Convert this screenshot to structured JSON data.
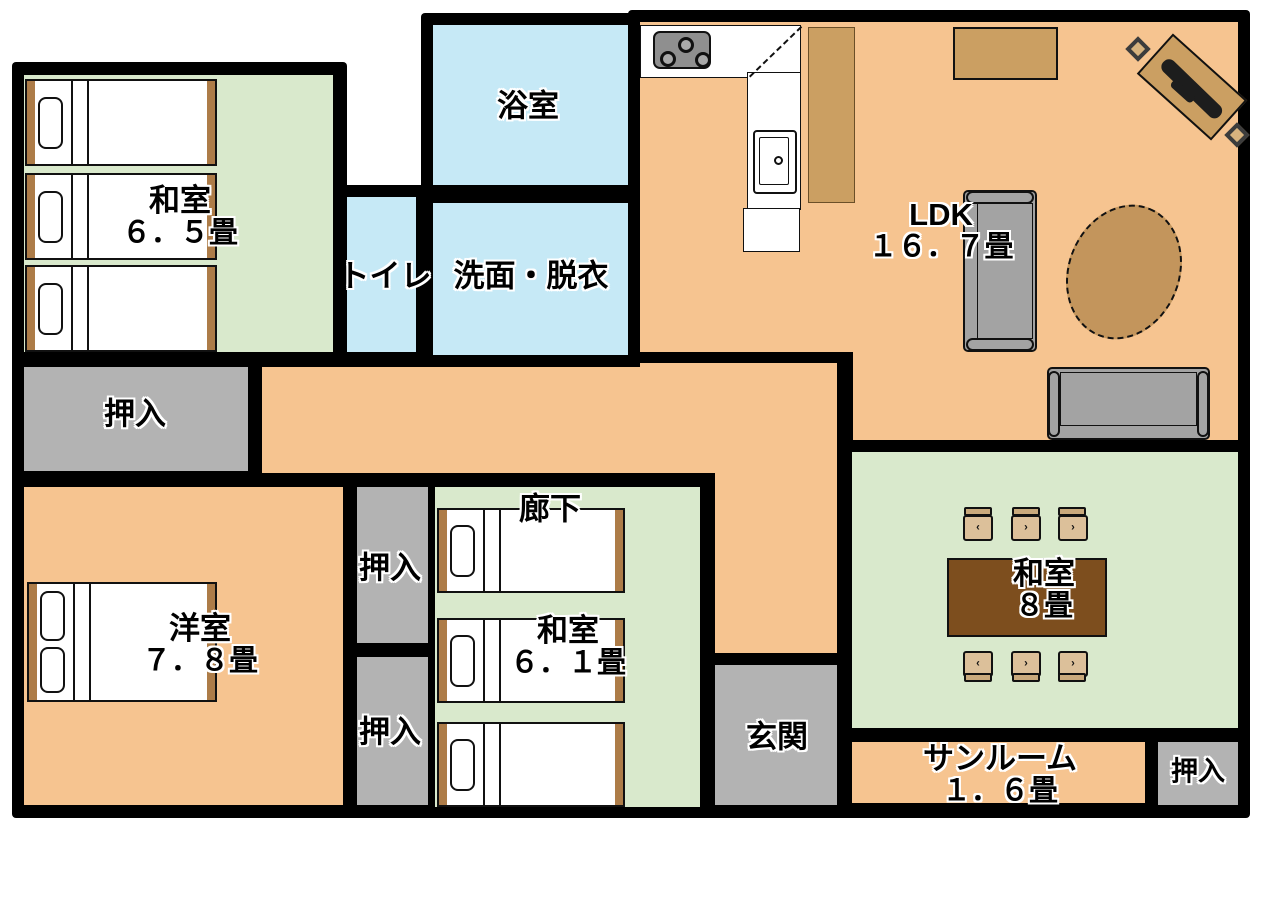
{
  "plan": {
    "title": "間取り図",
    "rooms": {
      "washitsu65": {
        "name": "和室",
        "area": "６．５畳"
      },
      "bath": {
        "name": "浴室"
      },
      "toilet": {
        "name": "トイレ"
      },
      "senmen": {
        "name": "洗面・脱衣"
      },
      "ldk": {
        "name": "LDK",
        "area": "１６．７畳"
      },
      "oshiire_left": {
        "name": "押入"
      },
      "rouka": {
        "name": "廊下"
      },
      "oshiire_mid_top": {
        "name": "押入"
      },
      "oshiire_mid_bottom": {
        "name": "押入"
      },
      "yoshitsu": {
        "name": "洋室",
        "area": "７．８畳"
      },
      "washitsu61": {
        "name": "和室",
        "area": "６．１畳"
      },
      "genkan": {
        "name": "玄関"
      },
      "washitsu8": {
        "name": "和室",
        "area": "８畳"
      },
      "sunroom": {
        "name": "サンルーム",
        "area": "１．６畳"
      },
      "oshiire_br": {
        "name": "押入"
      }
    },
    "colors": {
      "wall": "#000000",
      "floor": "#f6c490",
      "tatami": "#d9e9cc",
      "water": "#c6e9f6",
      "closet": "#b3b3b3",
      "wood": "#ad7c48",
      "tan": "#cb9f62",
      "rug": "#c3955c",
      "table": "#7d4e1e",
      "cushion": "#dcc09a",
      "sofa": "#a3a3a3",
      "stove": "#8f8f8f"
    }
  }
}
